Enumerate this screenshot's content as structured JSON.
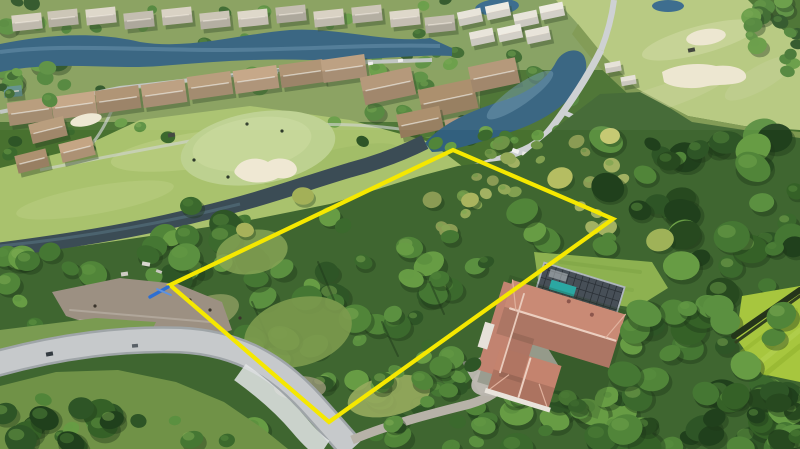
{
  "image": {
    "type": "aerial-drone-photograph",
    "subject": "Vacant wooded residential lot outlined in yellow inside a golf-course community",
    "width_px": 800,
    "height_px": 449
  },
  "boundary": {
    "label": "property-boundary",
    "points": "453,150 613,219 329,422 170,285",
    "color": "#F5E800",
    "stroke_width": 4.2,
    "survey_marker_color": "#2E6FD2"
  },
  "features": [
    {
      "name": "neighborhood-homes-north",
      "description": "Rows of single-family homes with gray and tan tile roofs along a winding lake"
    },
    {
      "name": "community-lake",
      "description": "Dark blue winding lake across the upper left"
    },
    {
      "name": "putting-green-west",
      "description": "Bright putting green with kidney-shaped sand bunker and golfers"
    },
    {
      "name": "fairway-east",
      "description": "Fairway at upper right with two white sand bunkers and a golf cart"
    },
    {
      "name": "canal",
      "description": "Narrow water channel running along the golf hole"
    },
    {
      "name": "center-pond",
      "description": "Pond beside cart path at center"
    },
    {
      "name": "cart-path",
      "description": "Light gray golf cart path winding between pond and greens"
    },
    {
      "name": "wooded-lot",
      "description": "Densely treed vacant parcel enclosed by the yellow boundary"
    },
    {
      "name": "survey-marker",
      "description": "Small blue marker at the west corner of the boundary"
    },
    {
      "name": "street-southwest",
      "description": "Curving light-gray residential street with grass island"
    },
    {
      "name": "home-southeast",
      "description": "House with terracotta tile roof, screened pool enclosure, teal pool and paver driveway"
    },
    {
      "name": "mowed-field-east",
      "description": "Striped bright green lawn behind a fence at the right edge"
    }
  ],
  "palette": {
    "boundary_yellow": "#F5E800",
    "marker_blue": "#2E6FD2",
    "lake_water": "#32607E",
    "canal_water": "#3B4C55",
    "fairway_green": "#ABC46F",
    "putting_green": "#BDD190",
    "bunker_sand": "#EFE8D3",
    "tree_canopy": "#3F6630",
    "roof_gray": "#D7CFC0",
    "roof_tan": "#B79A79",
    "roof_white": "#E8E4DA",
    "house_roof_terracotta": "#C48471",
    "pool_teal": "#2BA7A2",
    "pool_enclosure": "#474F57",
    "road_asphalt": "#C6C9CB",
    "driveway_paver": "#BDB9B1",
    "dirt_frontage": "#9C9082",
    "mowed_field": "#A7C63E"
  }
}
